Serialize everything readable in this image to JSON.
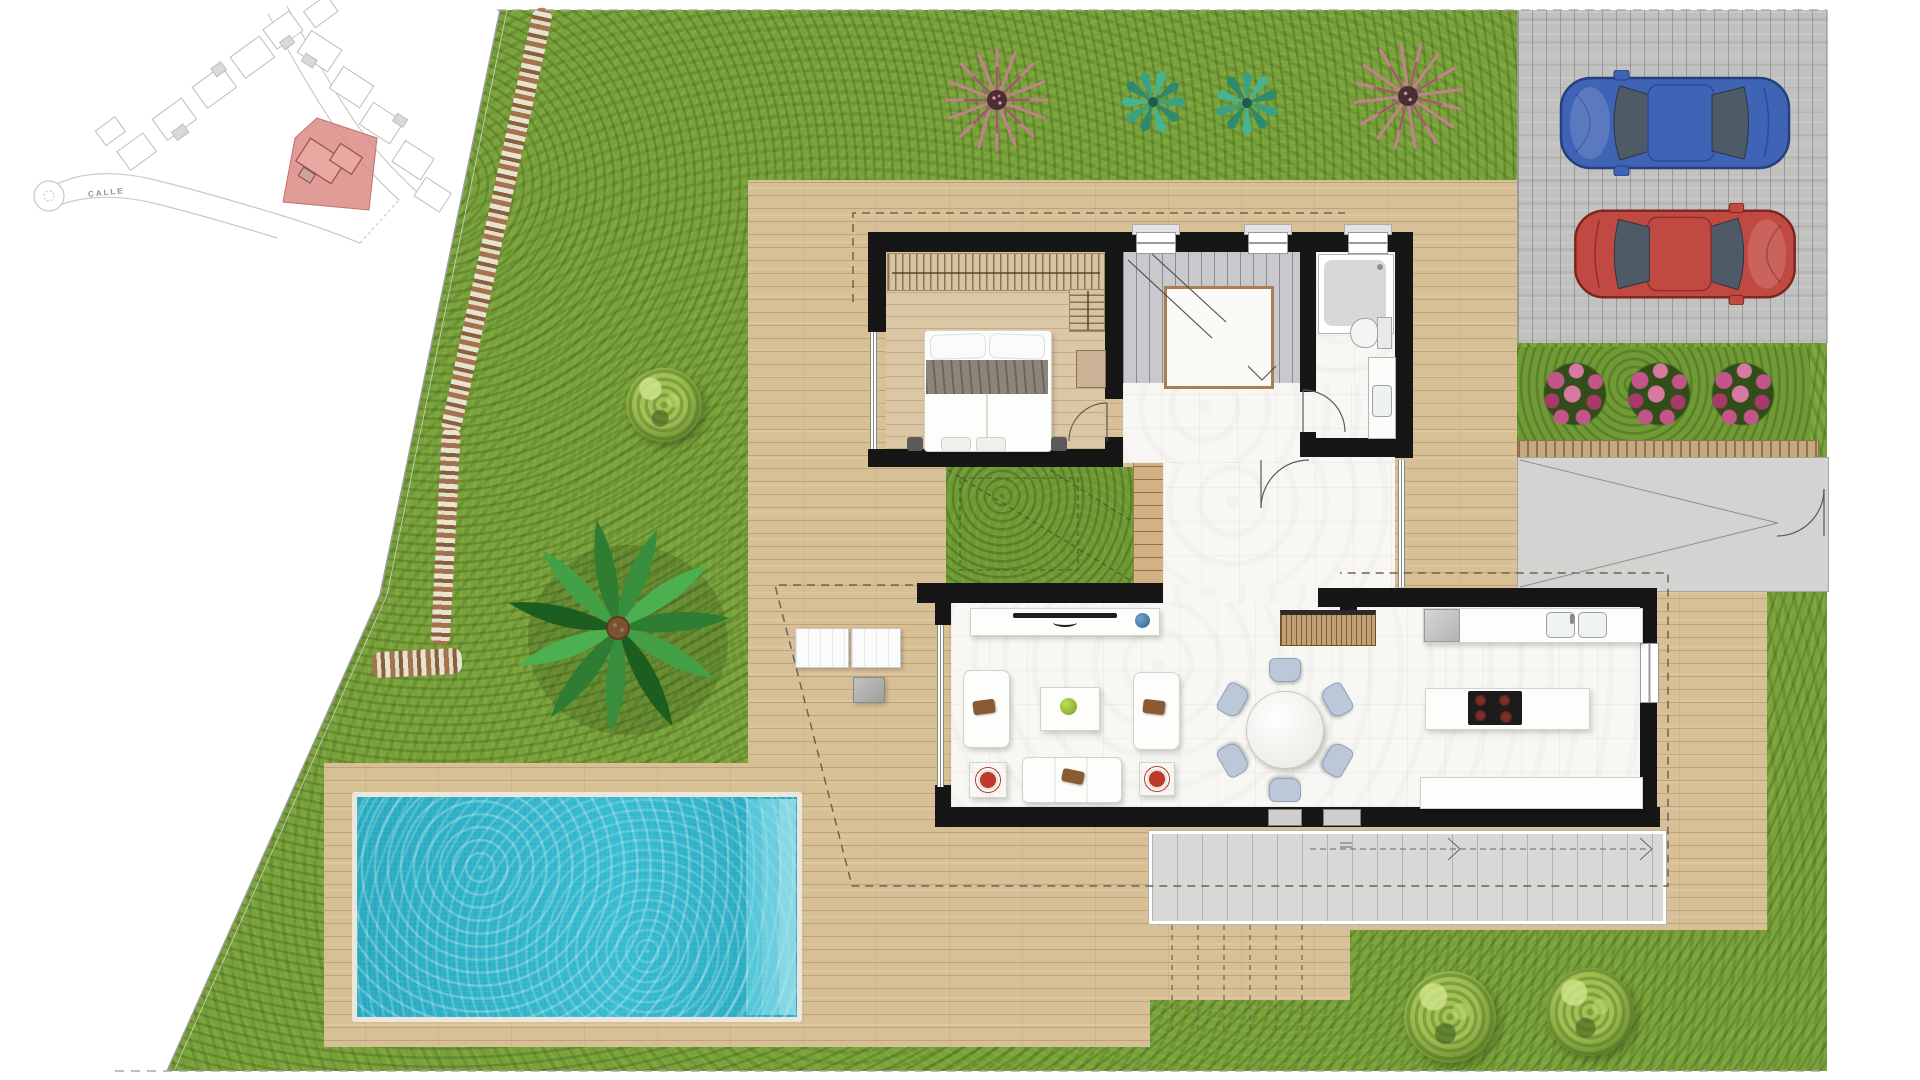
{
  "page": {
    "type": "architectural-site-plan",
    "description": "Top-view colour site plan of a villa plot with garden, pool, parking deck and furnished ground floor"
  },
  "inset_map": {
    "street_label": "CALLE",
    "highlighted_plot": "selected villa plot",
    "house_count": 13
  },
  "colors": {
    "lawn": "#7aa23a",
    "deck": "#d8c096",
    "wall": "#161616",
    "floor": "#f8f7f3",
    "stair": "#c9c9cd",
    "water": "#2ab7cf",
    "cardeck": "#c1c1bf",
    "terrace": "#d8d8d6",
    "ramp": "#d3d3d1",
    "stone": "#c6a87f",
    "flower": "#c2558a",
    "chair": "#bcc8d8",
    "bluecar": "#3f64b5",
    "redcar": "#c04a42",
    "highlight": "#db8c85"
  },
  "garden": {
    "trees": [
      {
        "name": "pink-grass-tree-left"
      },
      {
        "name": "agave-left"
      },
      {
        "name": "agave-right"
      },
      {
        "name": "pink-grass-tree-right"
      },
      {
        "name": "palm-tree"
      }
    ],
    "round_bushes": 3,
    "flower_clumps": 3,
    "stone_path": "diagonal pebble path along west boundary"
  },
  "pool": {
    "shape": "rectangular",
    "steps": 3
  },
  "driveway": {
    "surface": "grey timber deck",
    "cars": [
      {
        "name": "blue-car",
        "color": "#3f64b5"
      },
      {
        "name": "red-car",
        "color": "#c04a42"
      }
    ]
  },
  "house": {
    "rooms": [
      {
        "name": "bedroom",
        "furniture": [
          "double-bed",
          "wardrobe",
          "nightstands"
        ]
      },
      {
        "name": "staircase",
        "feature": "central-void"
      },
      {
        "name": "bathroom",
        "furniture": [
          "shower",
          "toilet",
          "washbasin"
        ]
      },
      {
        "name": "hall"
      },
      {
        "name": "inner-courtyard",
        "surface": "grass"
      },
      {
        "name": "living-room",
        "furniture": [
          "tv-sideboard",
          "tv",
          "armchairs",
          "sofa",
          "coffee-table",
          "side-tables"
        ]
      },
      {
        "name": "dining-area",
        "furniture": [
          "round-table"
        ],
        "chairs": 6
      },
      {
        "name": "kitchen",
        "furniture": [
          "fridge",
          "counter-with-double-sink",
          "island-with-hob",
          "bench"
        ],
        "hob_burners": 4
      }
    ],
    "outdoor": [
      "sun-loungers",
      "side-table",
      "south-terrace",
      "east-ramp"
    ],
    "sun_loungers": 2
  }
}
